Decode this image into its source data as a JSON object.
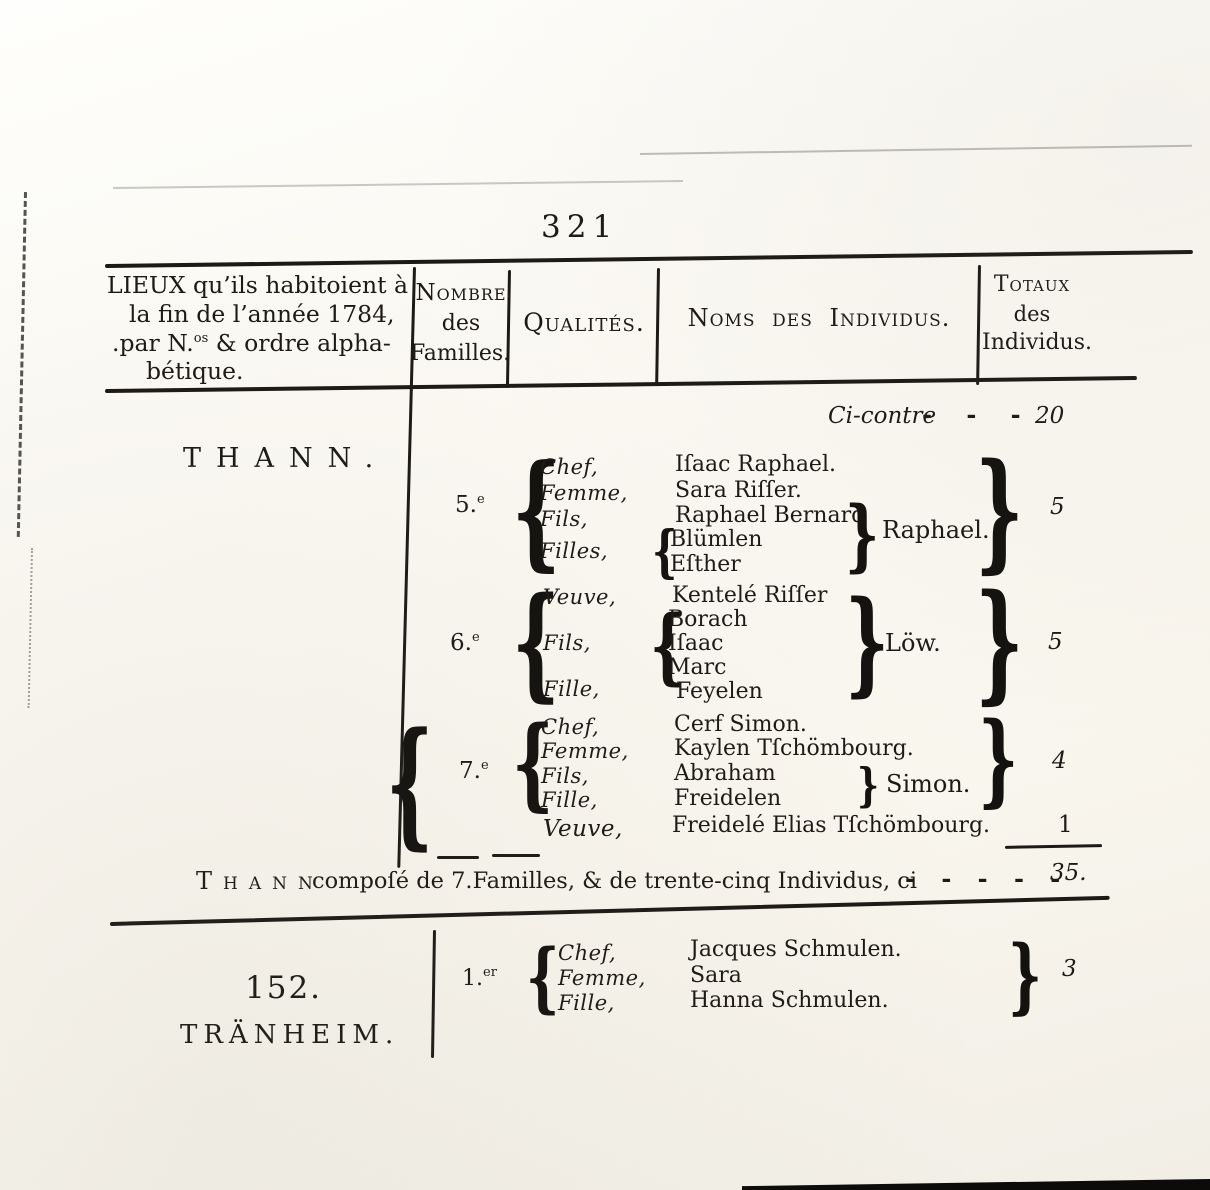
{
  "page": {
    "number": "321"
  },
  "colors": {
    "ink": "#1d1a16",
    "paper": "#faf8f2"
  },
  "glyphs": {
    "brace_left": "{",
    "brace_right": "}"
  },
  "header": {
    "lieux_line1": "LIEUX qu’ils habitoient à",
    "lieux_line2": "la fin de l’année 1784,",
    "lieux_line3_pre": ".par N.",
    "lieux_line3_sup": "os",
    "lieux_line3_post": " & ordre alpha-",
    "lieux_line4": "bétique.",
    "nombre_line1": "Nombre",
    "nombre_line2": "des",
    "nombre_line3": "Familles.",
    "qualites": "Qualités.",
    "noms": "Noms des Individus.",
    "totaux_line1": "Totaux",
    "totaux_line2": "des",
    "totaux_line3": "Individus."
  },
  "carryover": {
    "label": "Ci-contre",
    "dashes": "- - -",
    "value": "20"
  },
  "thann": {
    "title": "THANN.",
    "families": [
      {
        "number": "5.",
        "number_sup": "e",
        "qualities": [
          "Chef,",
          "Femme,",
          "Fils,",
          "Filles,"
        ],
        "members": [
          "Iſaac Raphael.",
          "Sara Riſſer.",
          "Raphael Bernard"
        ],
        "daughters": [
          "Blümlen",
          "Eſther"
        ],
        "group_surname": "Raphael.",
        "total": "5"
      },
      {
        "number": "6.",
        "number_sup": "e",
        "qualities": [
          "Veuve,",
          "Fils,",
          "Fille,"
        ],
        "widow": "Kentelé Riſſer",
        "sons": [
          "Borach",
          "Iſaac",
          "Marc"
        ],
        "daughter": "Feyelen",
        "group_surname": "Löw.",
        "total": "5"
      },
      {
        "number": "7.",
        "number_sup": "e",
        "qualities": [
          "Chef,",
          "Femme,",
          "Fils,",
          "Fille,"
        ],
        "members": [
          "Cerf Simon.",
          "Kaylen Tſchömbourg.",
          "Abraham",
          "Freidelen"
        ],
        "group_surname": "Simon.",
        "total": "4"
      }
    ],
    "widow_row": {
      "quality": "Veuve,",
      "name": "Freidelé Elias Tſchömbourg.",
      "total": "1"
    },
    "summary": {
      "town": "Thann",
      "text": "compoſé de 7.Familles, & de trente-cinq Individus, ci",
      "dashes": "- - - - -",
      "total": "35."
    }
  },
  "tranheim": {
    "number": "152.",
    "name": "TRÄNHEIM.",
    "family": {
      "number": "1.",
      "number_sup": "er",
      "qualities": [
        "Chef,",
        "Femme,",
        "Fille,"
      ],
      "members": [
        "Jacques Schmulen.",
        "Sara",
        "Hanna Schmulen."
      ],
      "total": "3"
    }
  }
}
